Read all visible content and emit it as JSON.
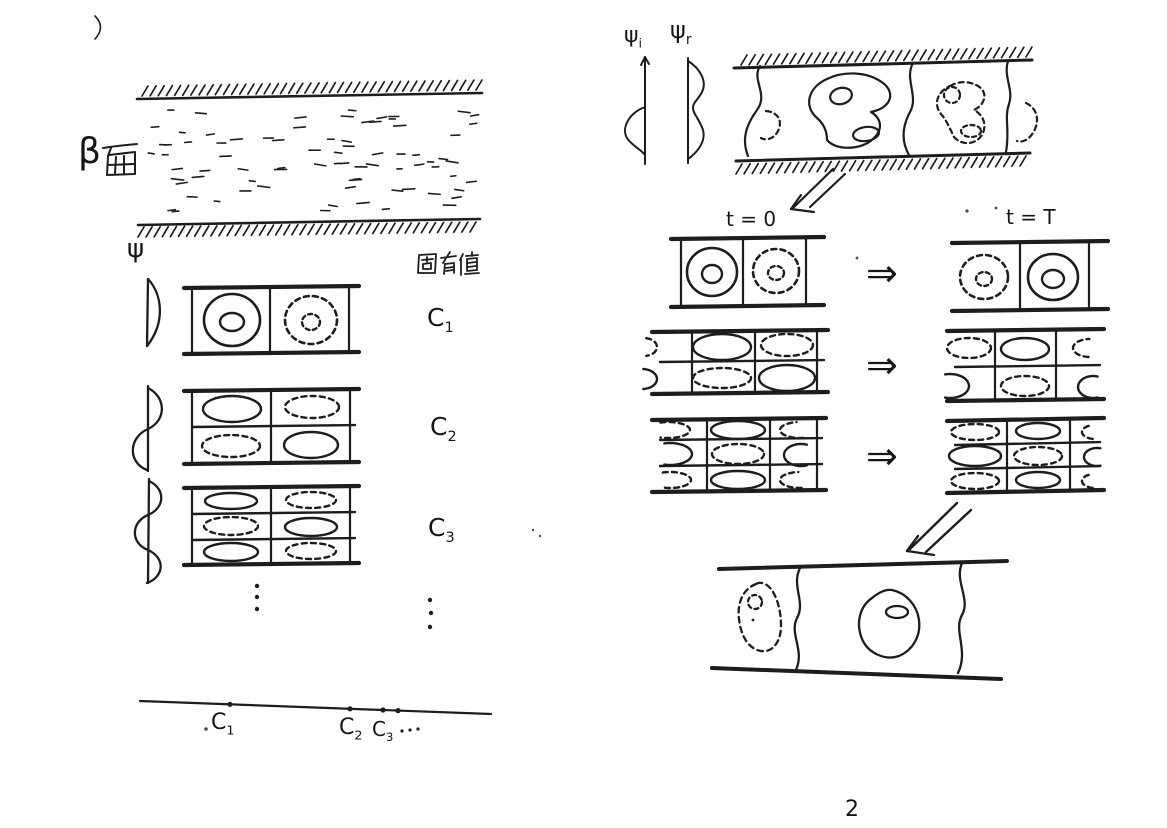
{
  "page": {
    "number": "2",
    "ink": "#1d1d1d",
    "paper": "#ffffff",
    "faint": "#c9c9c9"
  },
  "left": {
    "beta_plane_label": {
      "full": "β面",
      "beta": "β",
      "kanji": "面"
    },
    "psi_axis_label": "ψ",
    "eigenvalue_header": "固有値",
    "more_modes_ellipsis": "⋮",
    "modes": [
      {
        "label_base": "C",
        "label_sub": "1",
        "label_full": "C₁",
        "box": {
          "x1": 184,
          "x2": 359,
          "top": 288,
          "bottom": 354,
          "tilt": 2,
          "verticals": [
            192,
            270,
            349
          ],
          "dividers": [],
          "shapes": [
            {
              "type": "ring",
              "style": "solid",
              "cx": 232,
              "cy": 320,
              "rx": 28,
              "ry": 26,
              "irx": 12,
              "iry": 9
            },
            {
              "type": "ring",
              "style": "dashed",
              "cx": 311,
              "cy": 320,
              "rx": 26,
              "ry": 24,
              "irx": 9,
              "iry": 8
            }
          ]
        }
      },
      {
        "label_base": "C",
        "label_sub": "2",
        "label_full": "C₂",
        "box": {
          "x1": 184,
          "x2": 359,
          "top": 391,
          "bottom": 464,
          "tilt": 2,
          "verticals": [
            192,
            271,
            350
          ],
          "dividers": [
            427
          ],
          "shapes": [
            {
              "type": "ellipse",
              "style": "solid",
              "cx": 232,
              "cy": 409,
              "rx": 29,
              "ry": 13
            },
            {
              "type": "ellipse",
              "style": "dashed",
              "cx": 312,
              "cy": 407,
              "rx": 27,
              "ry": 11
            },
            {
              "type": "ellipse",
              "style": "dashed",
              "cx": 231,
              "cy": 446,
              "rx": 29,
              "ry": 11
            },
            {
              "type": "ellipse",
              "style": "solid",
              "cx": 311,
              "cy": 445,
              "rx": 27,
              "ry": 13
            }
          ]
        }
      },
      {
        "label_base": "C",
        "label_sub": "3",
        "label_full": "C₃",
        "box": {
          "x1": 184,
          "x2": 359,
          "top": 488,
          "bottom": 565,
          "tilt": 2,
          "verticals": [
            192,
            271,
            350
          ],
          "dividers": [
            514,
            540
          ],
          "shapes": [
            {
              "type": "ellipse",
              "style": "solid",
              "cx": 231,
              "cy": 501,
              "rx": 26,
              "ry": 8
            },
            {
              "type": "ellipse",
              "style": "dashed",
              "cx": 311,
              "cy": 500,
              "rx": 25,
              "ry": 8
            },
            {
              "type": "ellipse",
              "style": "dashed",
              "cx": 231,
              "cy": 526,
              "rx": 27,
              "ry": 9
            },
            {
              "type": "ellipse",
              "style": "solid",
              "cx": 311,
              "cy": 527,
              "rx": 26,
              "ry": 9
            },
            {
              "type": "ellipse",
              "style": "solid",
              "cx": 231,
              "cy": 552,
              "rx": 27,
              "ry": 9
            },
            {
              "type": "ellipse",
              "style": "dashed",
              "cx": 311,
              "cy": 551,
              "rx": 25,
              "ry": 8
            }
          ]
        }
      }
    ],
    "eigenvalue_axis": {
      "dots": [
        {
          "x": 230,
          "y": 704.3
        },
        {
          "x": 350,
          "y": 708.8
        },
        {
          "x": 383,
          "y": 710.0
        },
        {
          "x": 398,
          "y": 710.6
        }
      ],
      "labels": [
        {
          "base": "C",
          "sub": "1"
        },
        {
          "base": "C",
          "sub": "2"
        },
        {
          "base": "C",
          "sub": "3"
        }
      ],
      "ellipsis": "···"
    }
  },
  "right": {
    "psi_imag_label": {
      "base": "ψ",
      "sub": "i"
    },
    "psi_real_label": {
      "base": "ψ",
      "sub": "r"
    },
    "evolution": {
      "t0_label": "t = 0",
      "tT_label": "t = T",
      "arrow": "⇒",
      "rows": [
        {
          "t0_box": {
            "x1": 671,
            "x2": 824,
            "top": 239,
            "bottom": 307,
            "tilt": 2,
            "verticals": [
              681,
              743,
              806
            ],
            "dividers": [],
            "shapes": [
              {
                "type": "ring",
                "style": "solid",
                "cx": 712,
                "cy": 272,
                "rx": 25,
                "ry": 24,
                "irx": 10,
                "iry": 9
              },
              {
                "type": "ring",
                "style": "dashed",
                "cx": 776,
                "cy": 271,
                "rx": 23,
                "ry": 22,
                "irx": 8,
                "iry": 7
              }
            ]
          },
          "tT_box": {
            "x1": 952,
            "x2": 1108,
            "top": 243,
            "bottom": 311,
            "tilt": 2,
            "verticals": [
              1020,
              1089
            ],
            "dividers": [],
            "shapes": [
              {
                "type": "ring",
                "style": "dashed",
                "cx": 984,
                "cy": 277,
                "rx": 24,
                "ry": 22,
                "irx": 8,
                "iry": 7
              },
              {
                "type": "ring",
                "style": "solid",
                "cx": 1053,
                "cy": 277,
                "rx": 25,
                "ry": 23,
                "irx": 11,
                "iry": 9
              }
            ]
          }
        },
        {
          "t0_box": {
            "x1": 652,
            "x2": 828,
            "top": 332,
            "bottom": 394,
            "tilt": 2,
            "verticals": [
              692,
              755,
              817
            ],
            "dividers": [
              362
            ],
            "shapes": [
              {
                "type": "arc",
                "style": "dashed",
                "cx": 644,
                "cy": 347,
                "rx": 13,
                "ry": 9,
                "a0": -80,
                "a1": 80
              },
              {
                "type": "arc",
                "style": "solid",
                "cx": 642,
                "cy": 379,
                "rx": 15,
                "ry": 10,
                "a0": -85,
                "a1": 85
              },
              {
                "type": "ellipse",
                "style": "solid",
                "cx": 722,
                "cy": 347,
                "rx": 29,
                "ry": 13
              },
              {
                "type": "ellipse",
                "style": "dashed",
                "cx": 787,
                "cy": 345,
                "rx": 26,
                "ry": 11
              },
              {
                "type": "ellipse",
                "style": "dashed",
                "cx": 722,
                "cy": 378,
                "rx": 29,
                "ry": 10
              },
              {
                "type": "ellipse",
                "style": "solid",
                "cx": 787,
                "cy": 378,
                "rx": 28,
                "ry": 13
              }
            ]
          },
          "tT_box": {
            "x1": 947,
            "x2": 1104,
            "top": 331,
            "bottom": 401,
            "tilt": 2,
            "verticals": [
              995,
              1056
            ],
            "dividers": [
              367
            ],
            "shapes": [
              {
                "type": "ellipse",
                "style": "dashed",
                "cx": 969,
                "cy": 348,
                "rx": 22,
                "ry": 10
              },
              {
                "type": "ellipse",
                "style": "solid",
                "cx": 1025,
                "cy": 349,
                "rx": 24,
                "ry": 11
              },
              {
                "type": "arc",
                "style": "dashed",
                "cx": 1090,
                "cy": 348,
                "rx": 17,
                "ry": 9,
                "a0": 95,
                "a1": 268
              },
              {
                "type": "arc",
                "style": "solid",
                "cx": 950,
                "cy": 386,
                "rx": 19,
                "ry": 12,
                "a0": -105,
                "a1": 105
              },
              {
                "type": "ellipse",
                "style": "dashed",
                "cx": 1025,
                "cy": 386,
                "rx": 24,
                "ry": 10
              },
              {
                "type": "arc",
                "style": "solid",
                "cx": 1093,
                "cy": 387,
                "rx": 15,
                "ry": 11,
                "a0": 72,
                "a1": 288
              }
            ]
          }
        },
        {
          "t0_box": {
            "x1": 652,
            "x2": 826,
            "top": 420,
            "bottom": 492,
            "tilt": 2,
            "verticals": [
              707,
              770,
              817
            ],
            "dividers": [
              440,
              466
            ],
            "shapes": [
              {
                "type": "arc",
                "style": "dashed",
                "cx": 668,
                "cy": 430,
                "rx": 22,
                "ry": 8,
                "a0": -110,
                "a1": 110
              },
              {
                "type": "ellipse",
                "style": "solid",
                "cx": 738,
                "cy": 430,
                "rx": 27,
                "ry": 9
              },
              {
                "type": "arc",
                "style": "dashed",
                "cx": 800,
                "cy": 430,
                "rx": 20,
                "ry": 8,
                "a0": 80,
                "a1": 260
              },
              {
                "type": "arc",
                "style": "solid",
                "cx": 670,
                "cy": 454,
                "rx": 22,
                "ry": 11,
                "a0": -105,
                "a1": 105
              },
              {
                "type": "ellipse",
                "style": "dashed",
                "cx": 738,
                "cy": 454,
                "rx": 26,
                "ry": 10
              },
              {
                "type": "arc",
                "style": "solid",
                "cx": 801,
                "cy": 455,
                "rx": 17,
                "ry": 11,
                "a0": 70,
                "a1": 290
              },
              {
                "type": "arc",
                "style": "dashed",
                "cx": 670,
                "cy": 480,
                "rx": 21,
                "ry": 8,
                "a0": -110,
                "a1": 110
              },
              {
                "type": "ellipse",
                "style": "solid",
                "cx": 738,
                "cy": 480,
                "rx": 27,
                "ry": 9
              },
              {
                "type": "arc",
                "style": "dashed",
                "cx": 800,
                "cy": 480,
                "rx": 20,
                "ry": 8,
                "a0": 85,
                "a1": 265
              }
            ]
          },
          "tT_box": {
            "x1": 947,
            "x2": 1104,
            "top": 421,
            "bottom": 493,
            "tilt": 3,
            "verticals": [
              1007,
              1070
            ],
            "dividers": [
              445,
              469
            ],
            "shapes": [
              {
                "type": "ellipse",
                "style": "dashed",
                "cx": 975,
                "cy": 432,
                "rx": 24,
                "ry": 8
              },
              {
                "type": "ellipse",
                "style": "solid",
                "cx": 1038,
                "cy": 431,
                "rx": 22,
                "ry": 8
              },
              {
                "type": "arc",
                "style": "dashed",
                "cx": 1095,
                "cy": 432,
                "rx": 13,
                "ry": 7,
                "a0": 100,
                "a1": 255
              },
              {
                "type": "ellipse",
                "style": "solid",
                "cx": 975,
                "cy": 456,
                "rx": 26,
                "ry": 10
              },
              {
                "type": "ellipse",
                "style": "dashed",
                "cx": 1038,
                "cy": 456,
                "rx": 24,
                "ry": 9
              },
              {
                "type": "arc",
                "style": "solid",
                "cx": 1097,
                "cy": 457,
                "rx": 13,
                "ry": 9,
                "a0": 75,
                "a1": 285
              },
              {
                "type": "ellipse",
                "style": "dashed",
                "cx": 975,
                "cy": 481,
                "rx": 24,
                "ry": 8
              },
              {
                "type": "ellipse",
                "style": "solid",
                "cx": 1038,
                "cy": 480,
                "rx": 22,
                "ry": 8
              },
              {
                "type": "arc",
                "style": "dashed",
                "cx": 1095,
                "cy": 481,
                "rx": 13,
                "ry": 7,
                "a0": 100,
                "a1": 255
              }
            ]
          }
        }
      ]
    }
  }
}
